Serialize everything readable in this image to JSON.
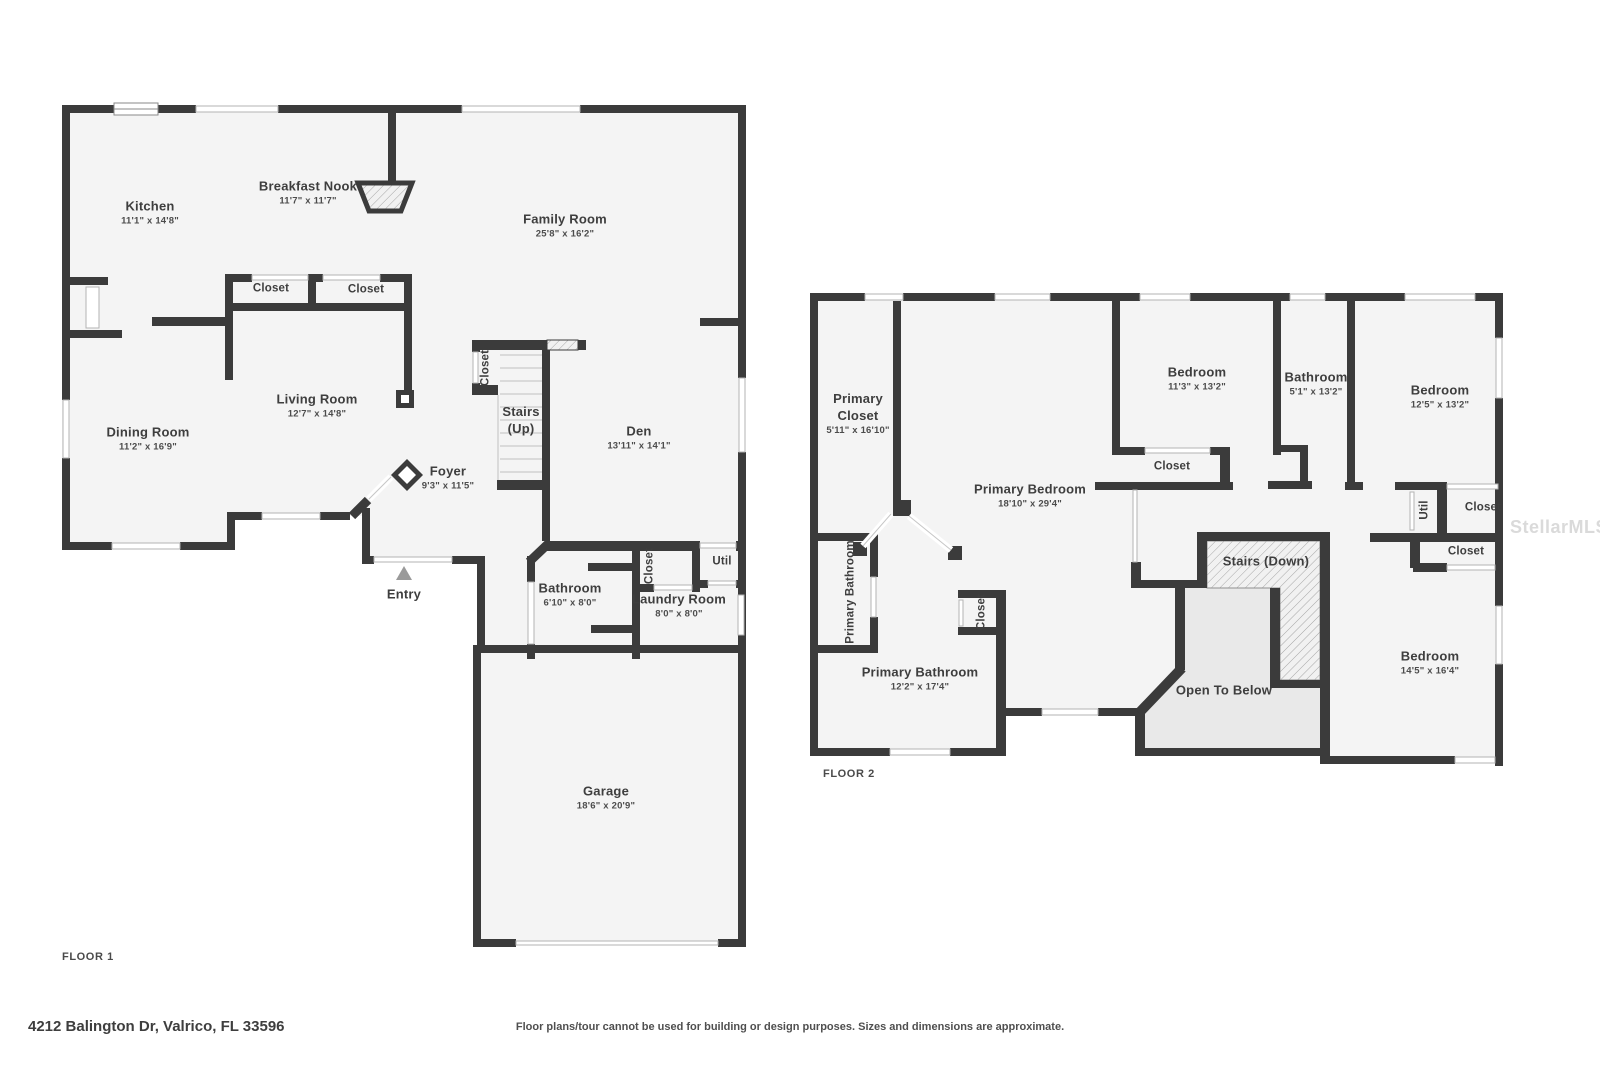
{
  "colors": {
    "wall": "#3b3b3b",
    "floor": "#f4f4f4",
    "open_below_fill": "#e9e9e9",
    "window_stroke": "#b3b3b3",
    "label_text": "#3e3e3e",
    "watermark": "#dadada",
    "entry_marker": "#9a9a9a"
  },
  "floor1": {
    "tag": "FLOOR 1",
    "rooms": [
      {
        "id": "kitchen",
        "x": 150,
        "y": 213,
        "lines": [
          "Kitchen",
          "11'1\" x 14'8\""
        ]
      },
      {
        "id": "breakfast-nook",
        "x": 308,
        "y": 193,
        "lines": [
          "Breakfast Nook",
          "11'7\" x 11'7\""
        ]
      },
      {
        "id": "family-room",
        "x": 565,
        "y": 226,
        "lines": [
          "Family Room",
          "25'8\" x 16'2\""
        ]
      },
      {
        "id": "closet-1",
        "x": 271,
        "y": 289,
        "lines": [
          "Closet"
        ],
        "small": true
      },
      {
        "id": "closet-2",
        "x": 366,
        "y": 290,
        "lines": [
          "Closet"
        ],
        "small": true
      },
      {
        "id": "living-room",
        "x": 317,
        "y": 406,
        "lines": [
          "Living Room",
          "12'7\" x 14'8\""
        ]
      },
      {
        "id": "dining-room",
        "x": 148,
        "y": 439,
        "lines": [
          "Dining Room",
          "11'2\" x 16'9\""
        ]
      },
      {
        "id": "stairs-closet",
        "x": 486,
        "y": 368,
        "lines": [
          "Closet"
        ],
        "small": true,
        "vertical": true
      },
      {
        "id": "stairs-up",
        "x": 521,
        "y": 421,
        "lines": [
          "Stairs",
          "(Up)"
        ]
      },
      {
        "id": "den",
        "x": 639,
        "y": 438,
        "lines": [
          "Den",
          "13'11\" x 14'1\""
        ]
      },
      {
        "id": "foyer",
        "x": 448,
        "y": 478,
        "lines": [
          "Foyer",
          "9'3\" x 11'5\""
        ]
      },
      {
        "id": "entry",
        "x": 404,
        "y": 595,
        "lines": [
          "Entry"
        ]
      },
      {
        "id": "bathroom",
        "x": 570,
        "y": 595,
        "lines": [
          "Bathroom",
          "6'10\" x 8'0\""
        ]
      },
      {
        "id": "laundry-closet",
        "x": 650,
        "y": 566,
        "lines": [
          "Closet"
        ],
        "small": true,
        "vertical": true
      },
      {
        "id": "util",
        "x": 722,
        "y": 562,
        "lines": [
          "Util"
        ],
        "small": true
      },
      {
        "id": "laundry-room",
        "x": 679,
        "y": 606,
        "lines": [
          "Laundry Room",
          "8'0\" x 8'0\""
        ]
      },
      {
        "id": "garage",
        "x": 606,
        "y": 798,
        "lines": [
          "Garage",
          "18'6\" x 20'9\""
        ]
      }
    ]
  },
  "floor2": {
    "tag": "FLOOR 2",
    "rooms": [
      {
        "id": "primary-closet",
        "x": 858,
        "y": 414,
        "lines": [
          "Primary",
          "Closet",
          "5'11\" x 16'10\""
        ]
      },
      {
        "id": "bedroom-1",
        "x": 1197,
        "y": 379,
        "lines": [
          "Bedroom",
          "11'3\" x 13'2\""
        ]
      },
      {
        "id": "bathroom-2",
        "x": 1316,
        "y": 384,
        "lines": [
          "Bathroom",
          "5'1\" x 13'2\""
        ]
      },
      {
        "id": "bedroom-2",
        "x": 1440,
        "y": 397,
        "lines": [
          "Bedroom",
          "12'5\" x 13'2\""
        ]
      },
      {
        "id": "primary-bedroom",
        "x": 1030,
        "y": 496,
        "lines": [
          "Primary Bedroom",
          "18'10\" x 29'4\""
        ]
      },
      {
        "id": "bedroom-1-closet",
        "x": 1172,
        "y": 467,
        "lines": [
          "Closet"
        ],
        "small": true
      },
      {
        "id": "util-2",
        "x": 1425,
        "y": 510,
        "lines": [
          "Util"
        ],
        "small": true,
        "vertical": true
      },
      {
        "id": "closet-right-1",
        "x": 1483,
        "y": 508,
        "lines": [
          "Closet"
        ],
        "small": true
      },
      {
        "id": "closet-right-2",
        "x": 1466,
        "y": 552,
        "lines": [
          "Closet"
        ],
        "small": true
      },
      {
        "id": "stairs-down",
        "x": 1266,
        "y": 562,
        "lines": [
          "Stairs (Down)"
        ]
      },
      {
        "id": "open-to-below",
        "x": 1224,
        "y": 691,
        "lines": [
          "Open To Below"
        ]
      },
      {
        "id": "bedroom-3",
        "x": 1430,
        "y": 663,
        "lines": [
          "Bedroom",
          "14'5\" x 16'4\""
        ]
      },
      {
        "id": "primary-bathroom-small",
        "x": 851,
        "y": 592,
        "lines": [
          "Primary Bathroom"
        ],
        "small": true,
        "vertical": true
      },
      {
        "id": "primary-bathroom-closet",
        "x": 982,
        "y": 612,
        "lines": [
          "Closet"
        ],
        "small": true,
        "vertical": true
      },
      {
        "id": "primary-bathroom",
        "x": 920,
        "y": 679,
        "lines": [
          "Primary Bathroom",
          "12'2\" x 17'4\""
        ]
      }
    ]
  },
  "footer": {
    "address": "4212 Balington Dr, Valrico, FL 33596",
    "disclaimer": "Floor plans/tour cannot be used for building or design purposes. Sizes and dimensions are approximate."
  },
  "watermark": "StellarMLS"
}
